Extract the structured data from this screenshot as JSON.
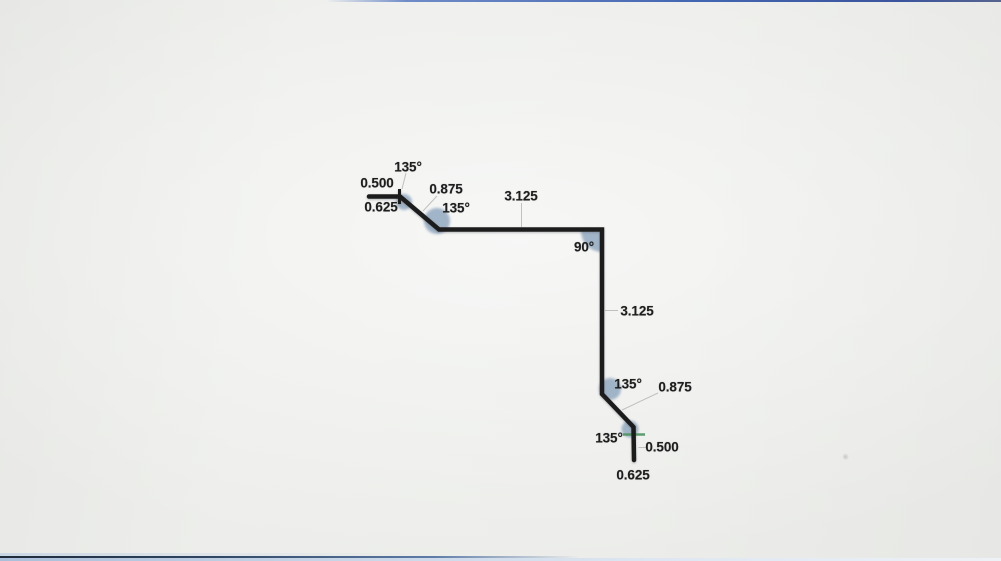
{
  "drawing": {
    "title": "bend-profile-dimension-drawing",
    "colors": {
      "stroke": "#1c1c1c",
      "bend_highlight": "#8aa3bc",
      "leader": "#b5b9b7",
      "start_tick": "#1c1c1c",
      "end_tick": "#4f9560",
      "screen_edge_top_blue": "#4466b2",
      "screen_edge_bottom_navy": "#2e4460",
      "screen_edge_bottom_light": "#c8d6e8"
    },
    "profile_summary": {
      "flat_lengths": [
        "0.500",
        "0.625",
        "0.875",
        "3.125",
        "3.125",
        "0.875",
        "0.500",
        "0.625"
      ],
      "bend_angles": [
        "135°",
        "135°",
        "90°",
        "135°",
        "135°"
      ]
    },
    "labels": [
      {
        "id": "angle-135-a",
        "text": "135°",
        "x": 408,
        "y": 167
      },
      {
        "id": "len-0500-start",
        "text": "0.500",
        "x": 377,
        "y": 183
      },
      {
        "id": "len-0875-top",
        "text": "0.875",
        "x": 446,
        "y": 189
      },
      {
        "id": "len-0625-start",
        "text": "0.625",
        "x": 381,
        "y": 207
      },
      {
        "id": "angle-135-b",
        "text": "135°",
        "x": 456,
        "y": 208
      },
      {
        "id": "len-3125-top",
        "text": "3.125",
        "x": 521,
        "y": 196
      },
      {
        "id": "angle-90",
        "text": "90°",
        "x": 584,
        "y": 247
      },
      {
        "id": "len-3125-right",
        "text": "3.125",
        "x": 637,
        "y": 311
      },
      {
        "id": "angle-135-c",
        "text": "135°",
        "x": 628,
        "y": 384
      },
      {
        "id": "len-0875-bottom",
        "text": "0.875",
        "x": 675,
        "y": 387
      },
      {
        "id": "angle-135-d",
        "text": "135°",
        "x": 609,
        "y": 438
      },
      {
        "id": "len-0500-end",
        "text": "0.500",
        "x": 662,
        "y": 447
      },
      {
        "id": "len-0625-end",
        "text": "0.625",
        "x": 633,
        "y": 475
      }
    ]
  }
}
